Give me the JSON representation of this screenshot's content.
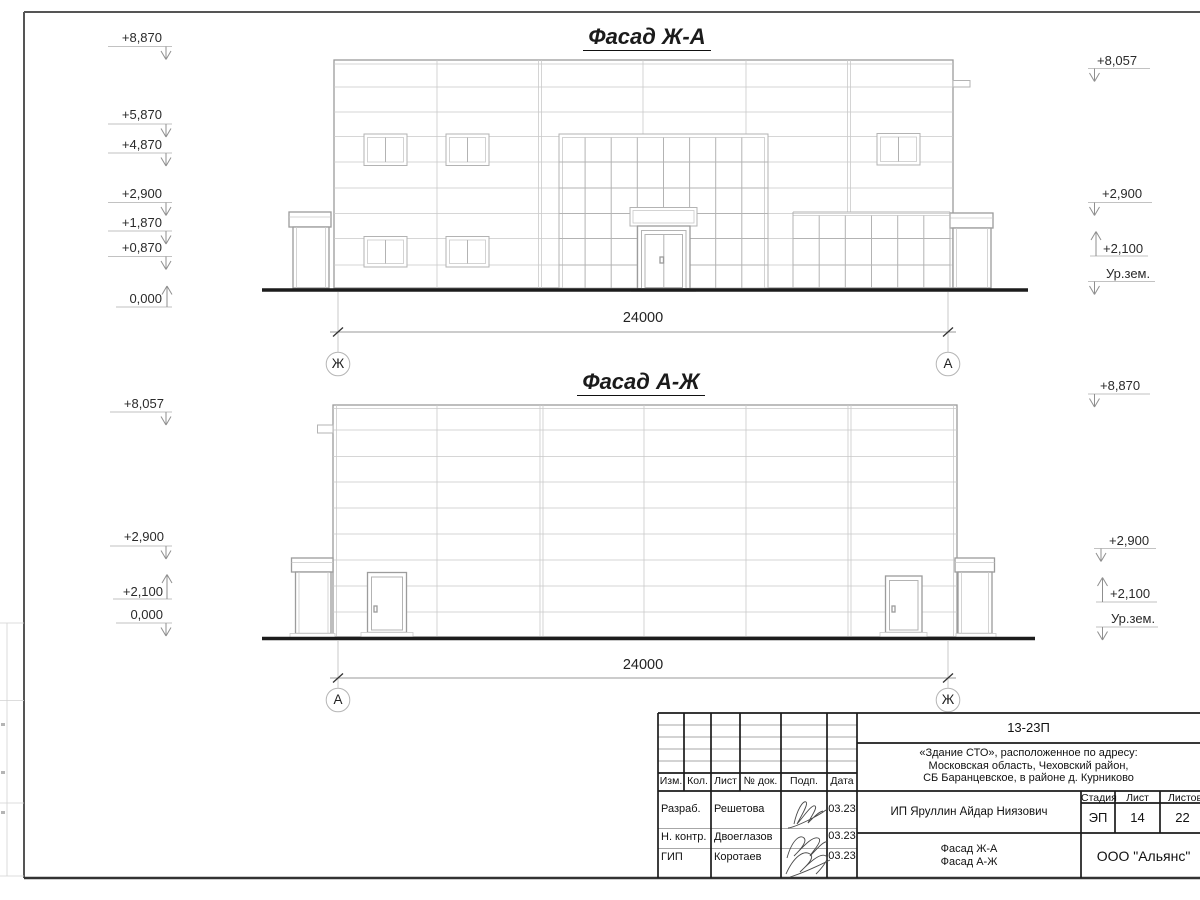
{
  "drawing1": {
    "title": "Фасад Ж-А",
    "dim": "24000",
    "axis_left": "Ж",
    "axis_right": "А",
    "marks_left": [
      "+8,870",
      "+5,870",
      "+4,870",
      "+2,900",
      "+1,870",
      "+0,870",
      "0,000"
    ],
    "marks_right": [
      "+8,057",
      "+2,900",
      "+2,100",
      "Ур.зем."
    ]
  },
  "drawing2": {
    "title": "Фасад А-Ж",
    "dim": "24000",
    "axis_left": "А",
    "axis_right": "Ж",
    "marks_left": [
      "+8,057",
      "+2,900",
      "+2,100",
      "0,000"
    ],
    "marks_right": [
      "+8,870",
      "+2,900",
      "+2,100",
      "Ур.зем."
    ]
  },
  "titleblock": {
    "doc_code": "13-23П",
    "address_line1": "«Здание СТО», расположенное по адресу:",
    "address_line2": "Московская область, Чеховский район,",
    "address_line3": "СБ Баранцевское, в районе д. Курниково",
    "col_izm": "Изм.",
    "col_kol": "Кол.",
    "col_list": "Лист",
    "col_ndok": "№ док.",
    "col_podp": "Подп.",
    "col_data": "Дата",
    "row1_role": "Разраб.",
    "row1_name": "Решетова",
    "row1_date": "03.23",
    "row2_role": "Н. контр.",
    "row2_name": "Двоеглазов",
    "row2_date": "03.23",
    "row3_role": "ГИП",
    "row3_name": "Коротаев",
    "row3_date": "03.23",
    "client": "ИП Яруллин Айдар Ниязович",
    "stage_label": "Стадия",
    "stage": "ЭП",
    "sheet_label": "Лист",
    "sheet": "14",
    "sheets_label": "Листов",
    "sheets": "22",
    "title_line1": "Фасад Ж-А",
    "title_line2": "Фасад А-Ж",
    "company": "ООО \"Альянс\""
  }
}
